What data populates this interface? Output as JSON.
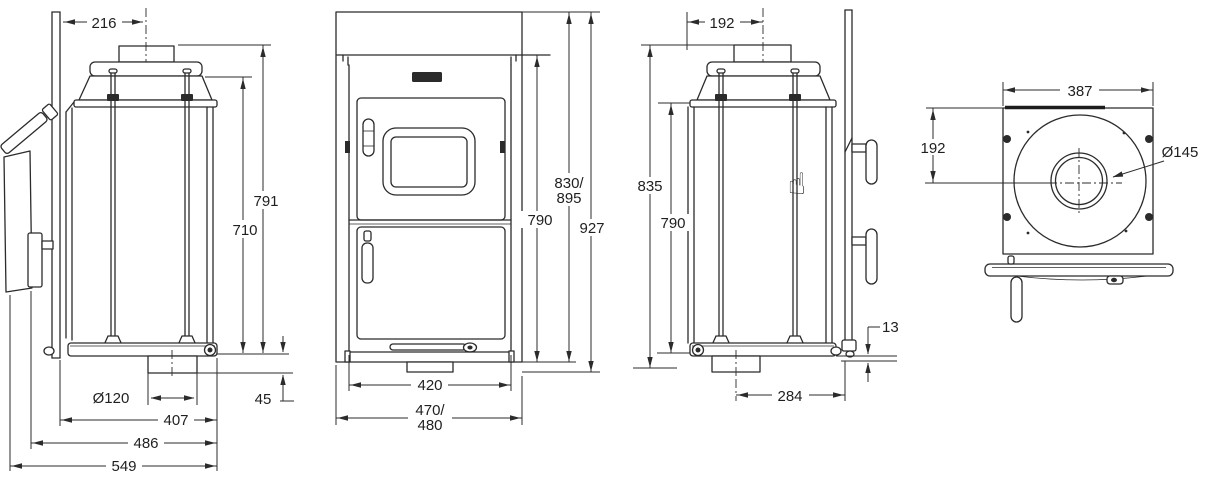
{
  "drawing": {
    "type": "stove-installation-dimension-drawing",
    "colors": {
      "line": "#2b2b2b",
      "background": "#ffffff",
      "logo": "#2b2b2b"
    },
    "icons": {
      "hand_cursor": "☝"
    }
  },
  "views": {
    "side_left": {
      "dims": {
        "flue_center_from_wall": "216",
        "height_to_flue_top": "791",
        "height_to_top_plate": "710",
        "floor_outlet_diameter": "Ø120",
        "depth_body": "407",
        "depth_incl_panel": "486",
        "depth_total": "549",
        "rear_clearance": "45"
      }
    },
    "front": {
      "dims": {
        "height_variant_line1": "830/",
        "height_variant_line2": "895",
        "height_body": "790",
        "height_total": "927",
        "width_body": "420",
        "width_variant_line1": "470/",
        "width_variant_line2": "480"
      }
    },
    "side_right": {
      "dims": {
        "flue_center_from_front": "192",
        "height_to_flue_top": "835",
        "height_body": "790",
        "floor_gap": "13",
        "pedestal_depth": "284"
      }
    },
    "top": {
      "dims": {
        "width": "387",
        "flue_center_offset": "192",
        "flue_diameter": "Ø145"
      }
    }
  }
}
